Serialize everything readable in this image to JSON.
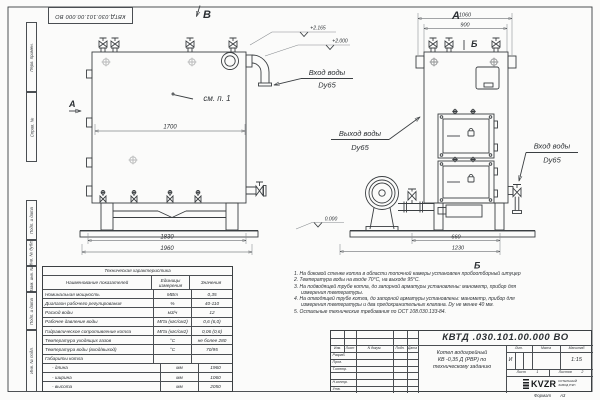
{
  "sheet": {
    "top_stamp": "КВТД.030.101.00.000 ВО",
    "format_label": "Формат",
    "format_value": "А3",
    "margin_fields": [
      "Перв. примен.",
      "Справ. №",
      "Подп. и дата",
      "Инв. № дубл.",
      "Взам. инв. №",
      "Подп. и дата",
      "Инв. № подл."
    ]
  },
  "views": {
    "front_label": "В",
    "side_label": "А",
    "side_arrow_label": "А",
    "section_top": "Б",
    "section_bottom": "Б",
    "see_note": "см. п. 1",
    "elev_top": "+2.165",
    "elev_mid": "+2.000",
    "elev_zero": "0.000",
    "dim_1700": "1700",
    "dim_1830": "1830",
    "dim_1960": "1960",
    "dim_1060": "1060",
    "dim_900": "900",
    "dim_660": "660",
    "dim_1230": "1230",
    "inlet_front": "Вход воды",
    "inlet_front_dn": "Dy65",
    "outlet": "Выход воды",
    "outlet_dn": "Dy65",
    "inlet_side": "Вход воды",
    "inlet_side_dn": "Dy65"
  },
  "notes": {
    "lines": [
      "1.  На боковой стенке котла в области топочной камеры установлен пробоотборный штуцер",
      "2.  Температура воды на входе 70°С, на выходе 95°С.",
      "3.  На подводящей трубе котла, до запорной арматуры установлены: манометр, прибор для",
      "измерения температуры.",
      "4.  На отводящей трубе котла, до запорной арматуры установлены: манометр, прибор для",
      "измерения температуры и два предохранительных клапана. Dу не менее 40 мм.",
      "5.  Остальные технические требования по ОСТ 108.030.133-84."
    ]
  },
  "spec_table": {
    "title": "Техническая характеристика",
    "col_headers": [
      "Наименование показателей",
      "Единицы измерения",
      "Значения"
    ],
    "rows": [
      {
        "name": "Номинальная мощность",
        "unit": "МВт",
        "value": "0,35"
      },
      {
        "name": "Диапазон рабочего регулирования",
        "unit": "%",
        "value": "40-110"
      },
      {
        "name": "Расход воды",
        "unit": "м3/ч",
        "value": "12"
      },
      {
        "name": "Рабочее давление воды",
        "unit": "МПа (кгс/см2)",
        "value": "0,6 (6,0)"
      },
      {
        "name": "Гидравлическое сопротивление котла",
        "unit": "МПа (кгс/см2)",
        "value": "0,06 (0,6)"
      },
      {
        "name": "Температура уходящих газов",
        "unit": "°С",
        "value": "не более 280"
      },
      {
        "name": "Температура воды (вход/выход)",
        "unit": "°С",
        "value": "70/95"
      },
      {
        "name": "Габариты котла",
        "unit": "",
        "value": ""
      },
      {
        "name": "- длина",
        "unit": "мм",
        "value": "1960"
      },
      {
        "name": "- ширина",
        "unit": "мм",
        "value": "1060"
      },
      {
        "name": "- высота",
        "unit": "мм",
        "value": "2050"
      }
    ]
  },
  "title_block": {
    "doc_number": "КВТД .030.101.00.000  ВО",
    "doc_name_line1": "Котел водогрейный",
    "doc_name_line2": "КВ -0,35 Д (РВР) по",
    "doc_name_line3": "техническому заданию",
    "header_cells": [
      "Изм.",
      "Лист",
      "N докум.",
      "Подп.",
      "Дата"
    ],
    "row_labels": [
      "Разраб.",
      "Пров.",
      "Т.контр.",
      "Н.контр.",
      "Утв."
    ],
    "lit_header": "Лит.",
    "mass_header": "Масса",
    "scale_header": "Масштаб",
    "lit_value": "И",
    "scale_value": "1:15",
    "sheet_label": "Лист",
    "sheet_value": "1",
    "sheets_label": "Листов",
    "sheets_value": "2",
    "logo_text": "KVZR",
    "logo_sub1": "КОТЕЛЬНЫЙ",
    "logo_sub2": "ЗАВОД РЭП"
  }
}
